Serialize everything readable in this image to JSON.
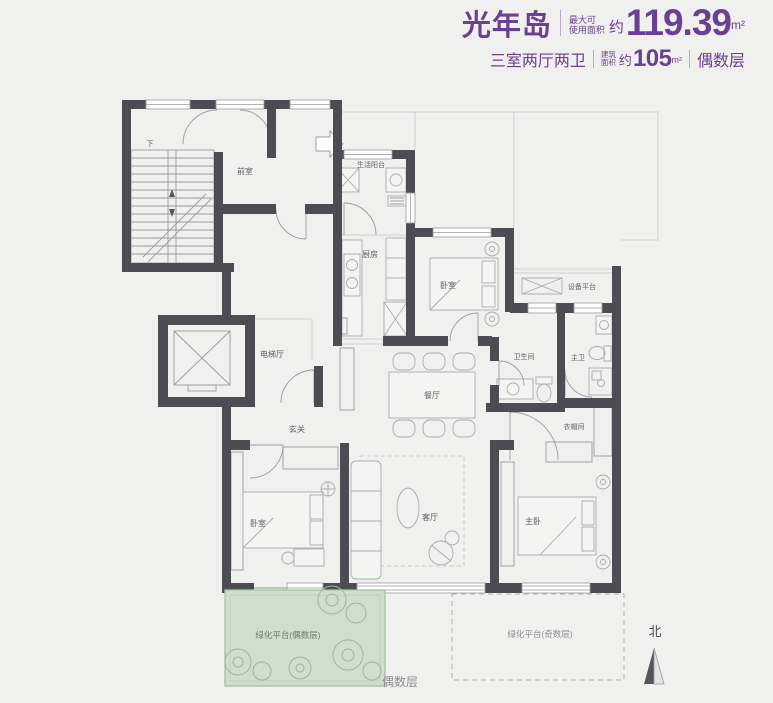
{
  "header": {
    "title": "光年岛",
    "max_label1": "最大可",
    "max_label2": "使用面积",
    "approx1": "约",
    "max_value": "119.39",
    "unit1": "m²",
    "layout_text": "三室两厅两卫",
    "built_label1": "建筑",
    "built_label2": "面积",
    "approx2": "约",
    "built_value": "105",
    "unit2": "m²",
    "parity": "偶数层"
  },
  "rooms": {
    "front_room": "前室",
    "life_balcony": "生活阳台",
    "kitchen": "厨房",
    "bedroom_top": "卧室",
    "equipment_platform": "设备平台",
    "elevator_hall": "电梯厅",
    "entry": "玄关",
    "dining": "餐厅",
    "bathroom": "卫生间",
    "master_bath": "主卫",
    "cloakroom": "衣帽间",
    "bedroom_left": "卧室",
    "living": "客厅",
    "master_bedroom": "主卧",
    "green_platform_even": "绿化平台(偶数层)",
    "green_platform_odd": "绿化平台(奇数层)",
    "stair_down": "下"
  },
  "compass": {
    "north": "北"
  },
  "footer": {
    "parity": "偶数层"
  },
  "colors": {
    "accent": "#6b3f93",
    "wall": "#4c4c52",
    "green_fill": "#cfdfca",
    "background": "#f0f0ee"
  }
}
